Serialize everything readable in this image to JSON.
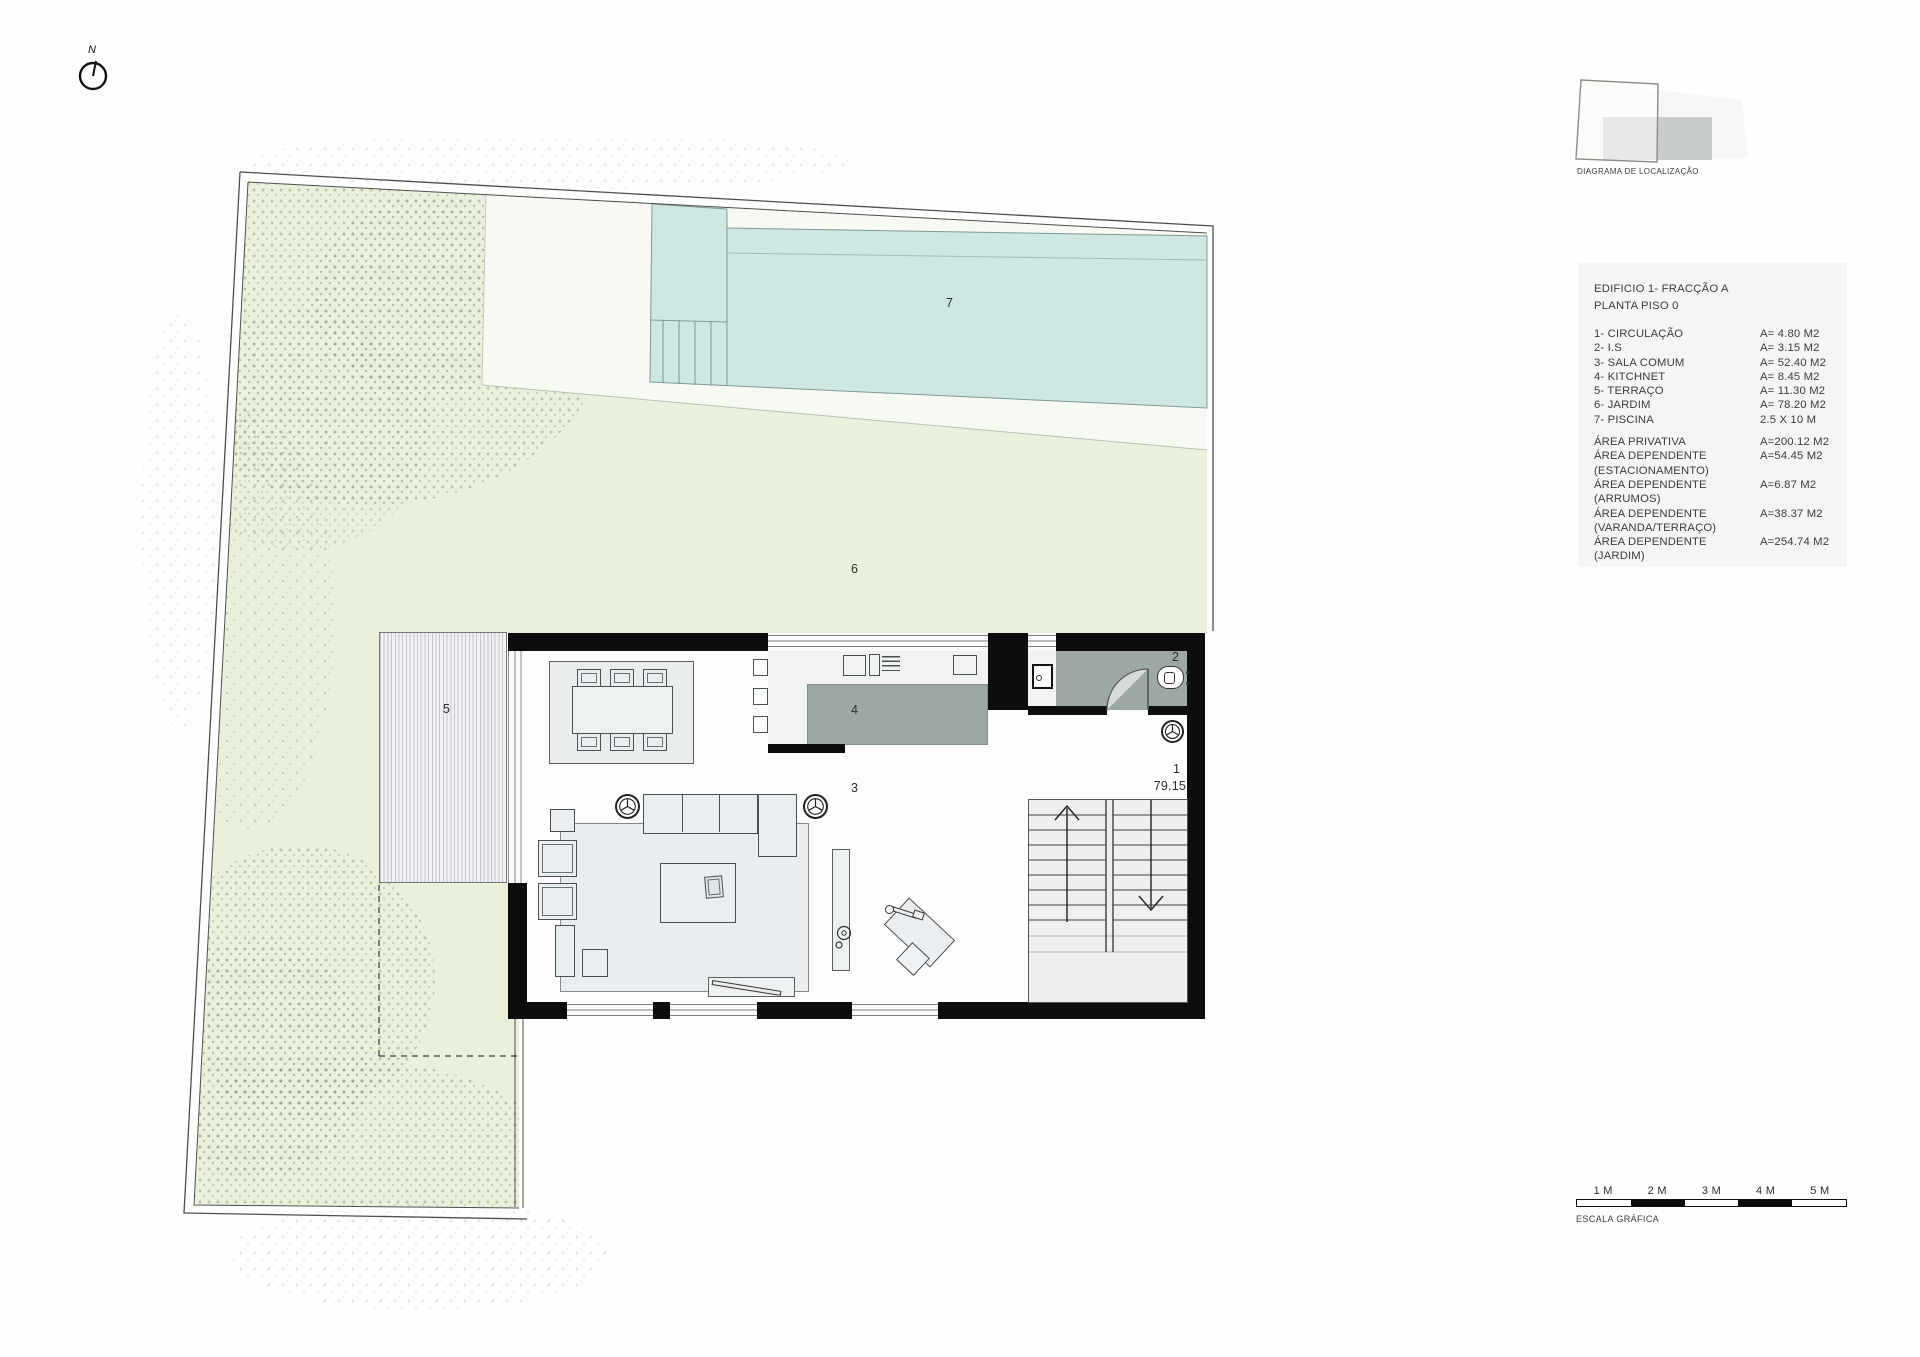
{
  "north_label": "N",
  "location_diagram": {
    "caption": "DIAGRAMA DE LOCALIZAÇÃO"
  },
  "legend": {
    "title_line1": "EDIFICIO 1- FRACÇÃO A",
    "title_line2": "PLANTA PISO 0",
    "rooms": [
      {
        "label": "1- CIRCULAÇÃO",
        "value": "A= 4.80 M2"
      },
      {
        "label": "2- I.S",
        "value": "A= 3.15 M2"
      },
      {
        "label": "3- SALA COMUM",
        "value": "A= 52.40 M2"
      },
      {
        "label": "4- KITCHNET",
        "value": "A= 8.45 M2"
      },
      {
        "label": "5- TERRAÇO",
        "value": "A= 11.30 M2"
      },
      {
        "label": "6- JARDIM",
        "value": "A= 78.20 M2"
      },
      {
        "label": "7- PISCINA",
        "value": "2.5 X 10 M"
      }
    ],
    "areas": [
      {
        "label": "ÁREA PRIVATIVA",
        "value": "A=200.12 M2"
      },
      {
        "label": "ÁREA DEPENDENTE (ESTACIONAMENTO)",
        "value": "A=54.45 M2"
      },
      {
        "label": "ÁREA DEPENDENTE (ARRUMOS)",
        "value": "A=6.87 M2"
      },
      {
        "label": "ÁREA DEPENDENTE (VARANDA/TERRAÇO)",
        "value": "A=38.37 M2"
      },
      {
        "label": "ÁREA DEPENDENTE (JARDIM)",
        "value": "A=254.74 M2"
      }
    ]
  },
  "plan": {
    "labels": {
      "hall": "1",
      "bathroom": "2",
      "living_room": "3",
      "kitchen": "4",
      "terrace": "5",
      "garden": "6",
      "pool": "7",
      "floor_level": "79.15"
    }
  },
  "scale_bar": {
    "labels": [
      "1 M",
      "2 M",
      "3 M",
      "4 M",
      "5 M"
    ],
    "caption": "ESCALA GRÁFICA"
  },
  "colors": {
    "garden_green": "#e9f0dc",
    "pool_blue": "#cfe7e2",
    "deck_white": "#f7faf2",
    "wall_black": "#0d0d0d",
    "wet_area_gray": "#9ca8a1",
    "furniture_fill": "#e9eef0",
    "legend_bg": "#f5f5f3",
    "text_dark": "#3c3c3c"
  }
}
